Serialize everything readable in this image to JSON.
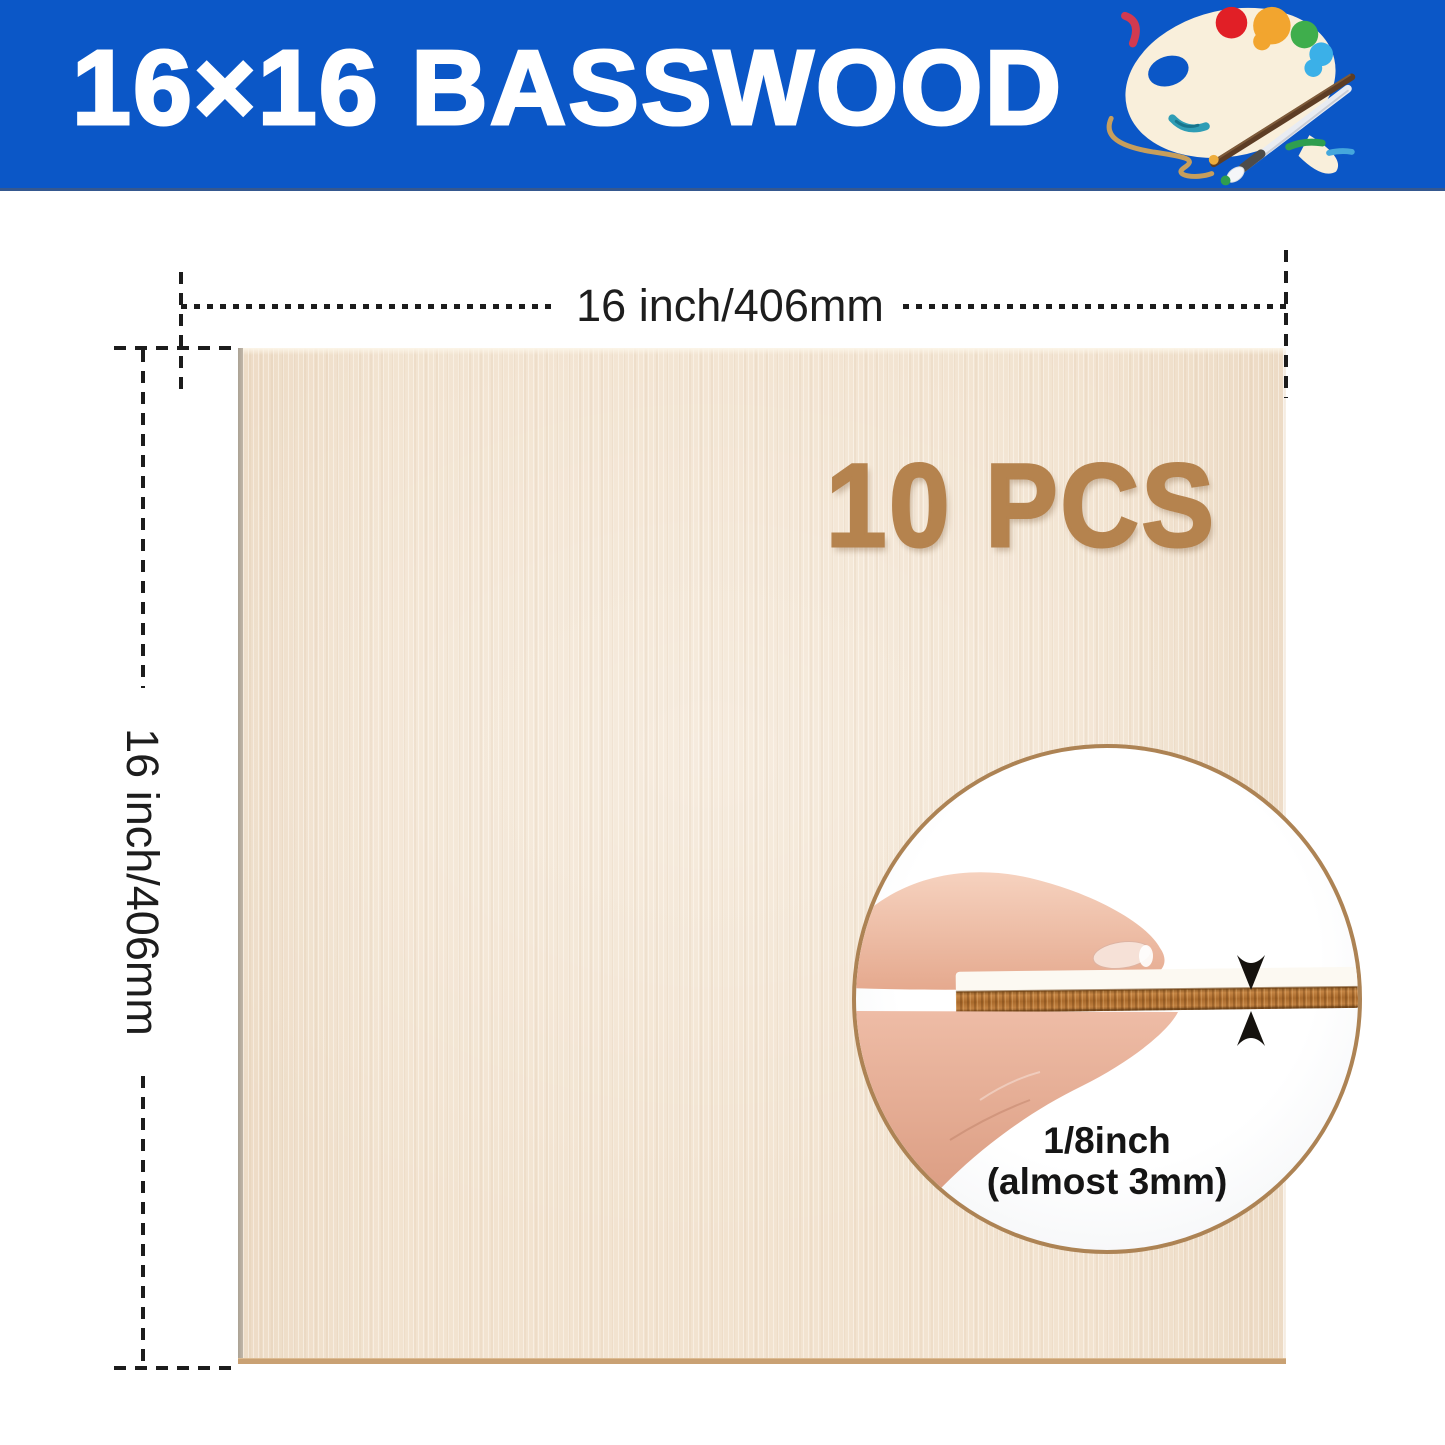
{
  "header": {
    "title": "16×16 BASSWOOD"
  },
  "board": {
    "piece_count": "10 PCS"
  },
  "dimensions": {
    "width_label": "16 inch/406mm",
    "height_label": "16 inch/406mm"
  },
  "magnifier": {
    "line1": "1/8inch",
    "line2": "(almost 3mm)"
  },
  "icons": {
    "palette": "paint-palette-icon",
    "thickness_arrows": [
      "arrow-down-icon",
      "arrow-up-icon"
    ]
  },
  "colors": {
    "banner_blue": "#0b57c7",
    "board_beige": "#f2e3d0",
    "count_brown": "#b5834e",
    "circle_border_tan": "#ad8354",
    "wood_edge_brown": "#b06f31",
    "dimension_line": "#1c1c1c"
  }
}
